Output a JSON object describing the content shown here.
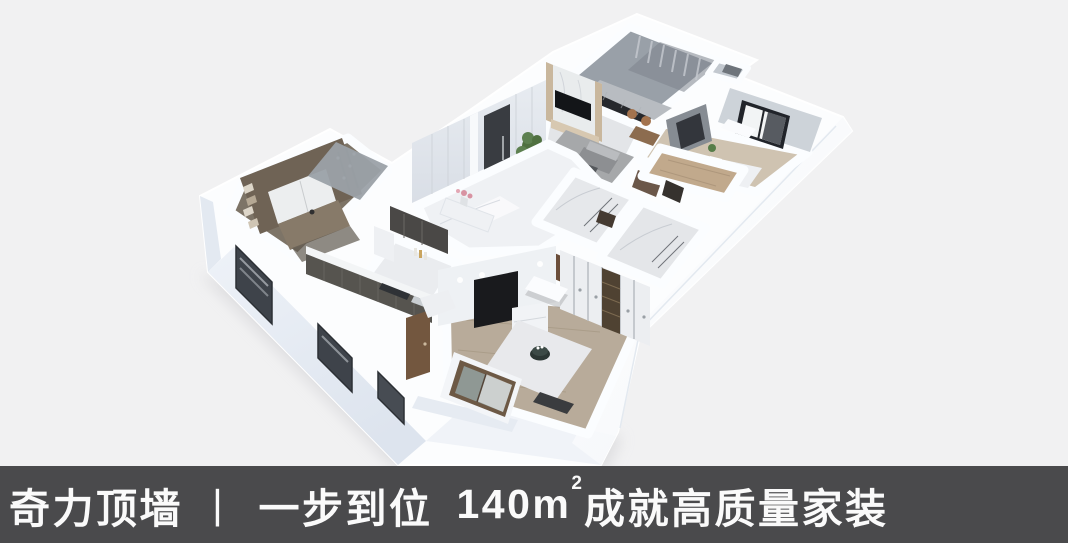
{
  "banner": {
    "brand": "奇力顶墙",
    "divider": "丨",
    "phrase": "一步到位",
    "area_value": "140m",
    "area_sup": "2",
    "tail": "成就高质量家装",
    "bg_color": "#4a4a4c",
    "text_color": "#fafafa"
  },
  "palette": {
    "page_background": "#f1f1f2",
    "wall_white": "#fcfdfe",
    "wall_shade": "#e3e9f1",
    "marble_floor": "#eff1f4",
    "wood_floor": "#c1a98c",
    "dark_cabinet": "#56544f",
    "bookshelf_wood": "#6f6355",
    "tv_black": "#17191c",
    "teal_accent": "#55968e",
    "plant_green": "#4f7040",
    "door_dark": "#393c41",
    "door_brown": "#73573f"
  },
  "floorplan": {
    "type": "3d-isometric-apartment-render",
    "rooms": [
      "balcony",
      "living-room",
      "entry-hall",
      "study",
      "kitchen",
      "bathroom-a",
      "bathroom-b",
      "corridor",
      "bedroom-right",
      "master-bedroom"
    ]
  }
}
